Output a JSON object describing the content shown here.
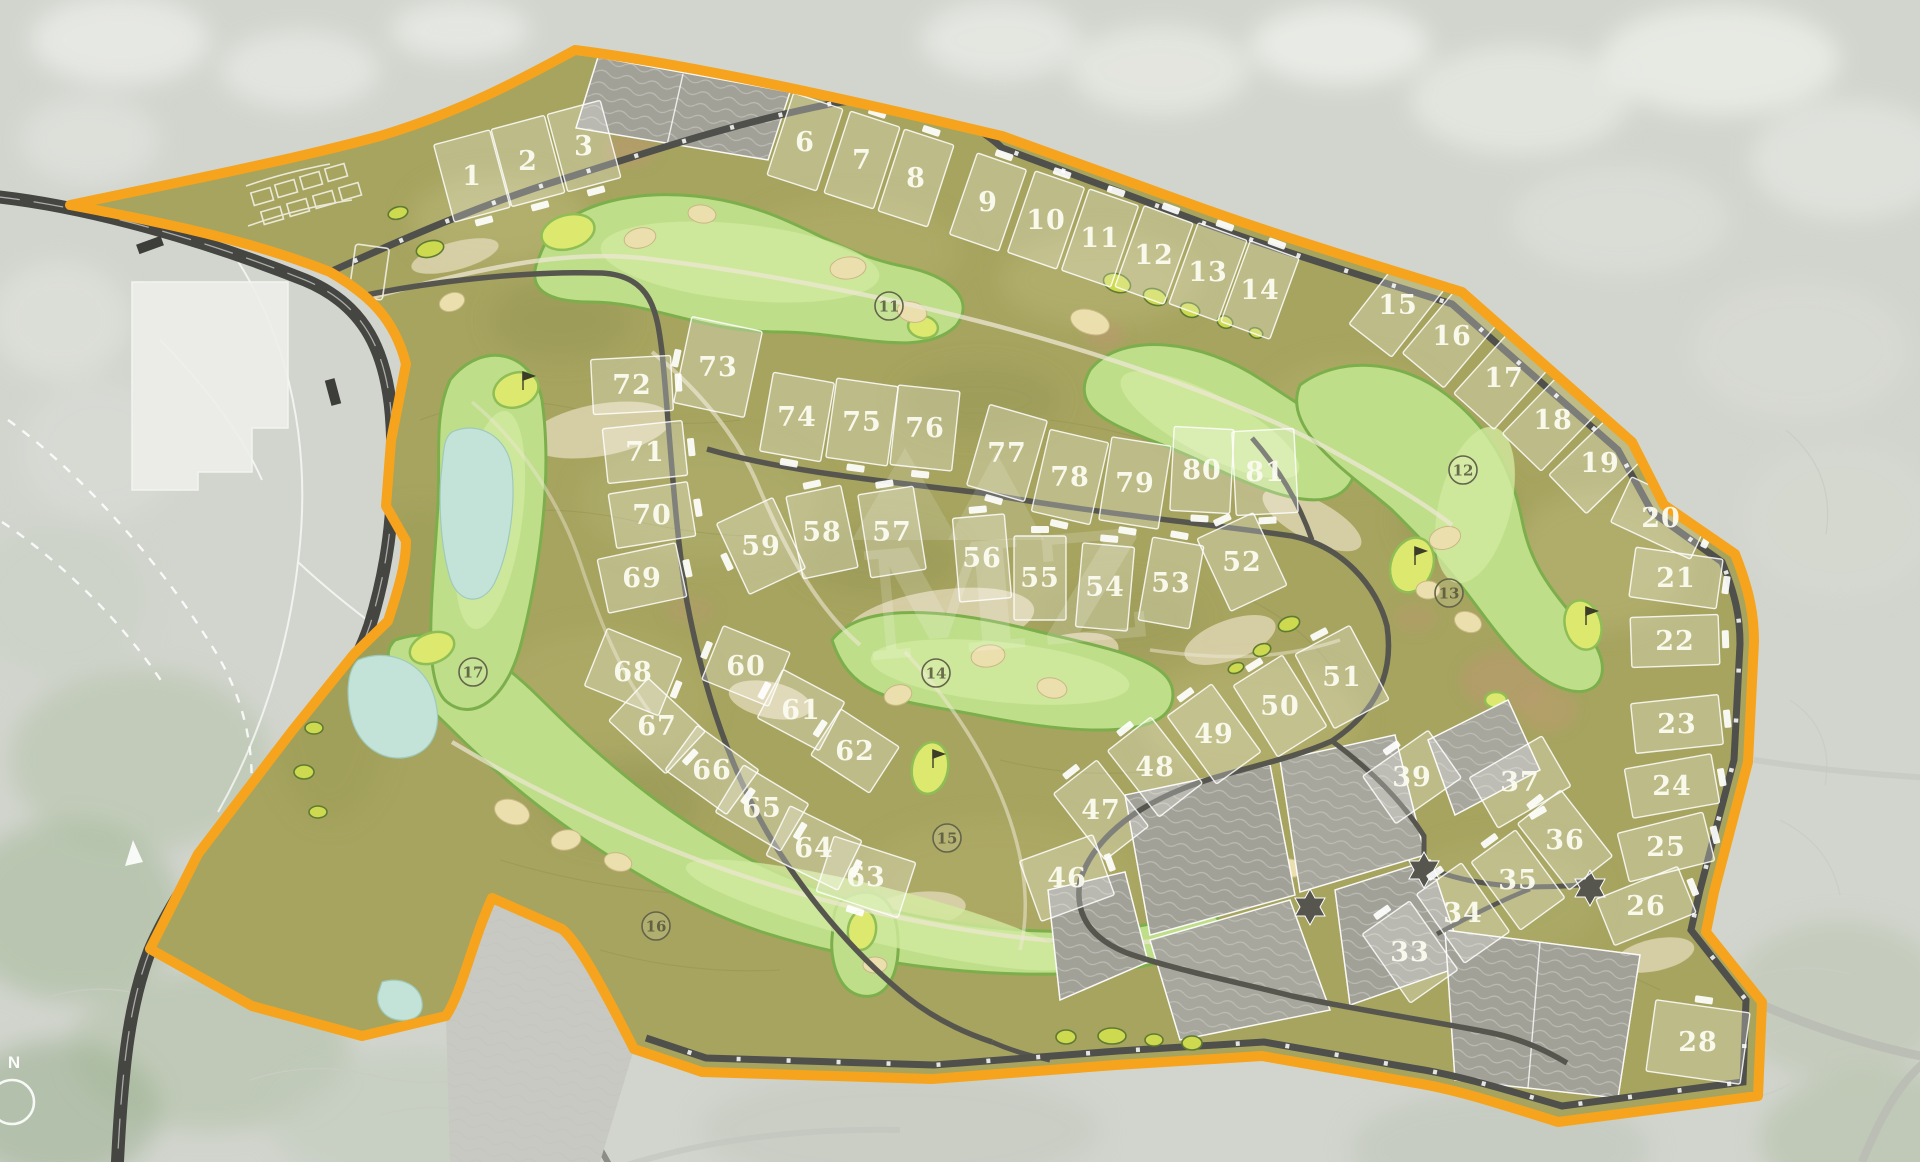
{
  "map": {
    "name": "golf-resort-master-plan",
    "watermark": {
      "text": "MZ"
    },
    "compass": {
      "label": "N"
    },
    "colors": {
      "boundary": "#F6A41D",
      "road": "#56564F",
      "loop_road": "#454542",
      "site_base": "#A6A45F",
      "fairway": "#BEDE8A",
      "fairway_edge": "#7DAE4C",
      "green": "#DCE96E",
      "bunker": "#ECDFAE",
      "water": "#C3E2D8",
      "sold_parcel": "#A2A198",
      "parcel_line": "#FFFFFF"
    },
    "plots": [
      {
        "n": "1",
        "x": 472,
        "y": 176,
        "a": -15,
        "w": 58,
        "h": 80,
        "g": "b"
      },
      {
        "n": "2",
        "x": 528,
        "y": 161,
        "a": -15,
        "w": 55,
        "h": 80,
        "g": "b"
      },
      {
        "n": "3",
        "x": 584,
        "y": 146,
        "a": -15,
        "w": 55,
        "h": 80,
        "g": "b"
      },
      {
        "n": "6",
        "x": 805,
        "y": 142,
        "a": 18,
        "w": 52,
        "h": 86,
        "g": "t"
      },
      {
        "n": "7",
        "x": 862,
        "y": 160,
        "a": 18,
        "w": 52,
        "h": 86,
        "g": "t"
      },
      {
        "n": "8",
        "x": 916,
        "y": 178,
        "a": 18,
        "w": 52,
        "h": 86,
        "g": "t"
      },
      {
        "n": "9",
        "x": 988,
        "y": 202,
        "a": 19,
        "w": 52,
        "h": 86,
        "g": "t"
      },
      {
        "n": "10",
        "x": 1046,
        "y": 220,
        "a": 19,
        "w": 52,
        "h": 86,
        "g": "t"
      },
      {
        "n": "11",
        "x": 1100,
        "y": 238,
        "a": 19,
        "w": 52,
        "h": 86,
        "g": "t"
      },
      {
        "n": "12",
        "x": 1154,
        "y": 255,
        "a": 20,
        "w": 52,
        "h": 86,
        "g": "t"
      },
      {
        "n": "13",
        "x": 1208,
        "y": 272,
        "a": 20,
        "w": 52,
        "h": 86,
        "g": "t"
      },
      {
        "n": "14",
        "x": 1260,
        "y": 290,
        "a": 20,
        "w": 52,
        "h": 86,
        "g": "t"
      },
      {
        "n": "15",
        "x": 1398,
        "y": 305,
        "a": 38,
        "w": 54,
        "h": 90,
        "g": "t"
      },
      {
        "n": "16",
        "x": 1452,
        "y": 336,
        "a": 40,
        "w": 54,
        "h": 90,
        "g": "t"
      },
      {
        "n": "17",
        "x": 1504,
        "y": 378,
        "a": 42,
        "w": 54,
        "h": 90,
        "g": "t"
      },
      {
        "n": "18",
        "x": 1553,
        "y": 420,
        "a": 44,
        "w": 54,
        "h": 90,
        "g": "t"
      },
      {
        "n": "19",
        "x": 1600,
        "y": 463,
        "a": 46,
        "w": 54,
        "h": 90,
        "g": "t"
      },
      {
        "n": "20",
        "x": 1661,
        "y": 518,
        "a": 25,
        "w": 88,
        "h": 50,
        "g": "r"
      },
      {
        "n": "21",
        "x": 1676,
        "y": 578,
        "a": 8,
        "w": 88,
        "h": 50,
        "g": "r"
      },
      {
        "n": "22",
        "x": 1675,
        "y": 641,
        "a": -2,
        "w": 88,
        "h": 50,
        "g": "r"
      },
      {
        "n": "23",
        "x": 1677,
        "y": 724,
        "a": -6,
        "w": 88,
        "h": 50,
        "g": "r"
      },
      {
        "n": "24",
        "x": 1672,
        "y": 786,
        "a": -10,
        "w": 88,
        "h": 50,
        "g": "r"
      },
      {
        "n": "25",
        "x": 1666,
        "y": 847,
        "a": -14,
        "w": 88,
        "h": 50,
        "g": "r"
      },
      {
        "n": "26",
        "x": 1646,
        "y": 906,
        "a": -22,
        "w": 88,
        "h": 50,
        "g": "r"
      },
      {
        "n": "28",
        "x": 1698,
        "y": 1042,
        "a": 8,
        "w": 95,
        "h": 72,
        "g": "t"
      },
      {
        "n": "33",
        "x": 1410,
        "y": 952,
        "a": -35,
        "w": 58,
        "h": 84,
        "g": "t"
      },
      {
        "n": "34",
        "x": 1463,
        "y": 913,
        "a": -35,
        "w": 55,
        "h": 84,
        "g": "t"
      },
      {
        "n": "35",
        "x": 1518,
        "y": 880,
        "a": -36,
        "w": 55,
        "h": 84,
        "g": "t"
      },
      {
        "n": "36",
        "x": 1565,
        "y": 840,
        "a": -38,
        "w": 55,
        "h": 84,
        "g": "t"
      },
      {
        "n": "37",
        "x": 1520,
        "y": 782,
        "a": -30,
        "w": 84,
        "h": 58,
        "g": "b"
      },
      {
        "n": "39",
        "x": 1412,
        "y": 777,
        "a": -35,
        "w": 80,
        "h": 58,
        "g": "t"
      },
      {
        "n": "46",
        "x": 1067,
        "y": 878,
        "a": -20,
        "w": 78,
        "h": 64,
        "g": "r"
      },
      {
        "n": "47",
        "x": 1101,
        "y": 810,
        "a": -38,
        "w": 55,
        "h": 84,
        "g": "t"
      },
      {
        "n": "48",
        "x": 1155,
        "y": 767,
        "a": -38,
        "w": 55,
        "h": 84,
        "g": "t"
      },
      {
        "n": "49",
        "x": 1214,
        "y": 734,
        "a": -36,
        "w": 55,
        "h": 84,
        "g": "t"
      },
      {
        "n": "50",
        "x": 1280,
        "y": 706,
        "a": -32,
        "w": 58,
        "h": 84,
        "g": "t"
      },
      {
        "n": "51",
        "x": 1342,
        "y": 677,
        "a": -28,
        "w": 62,
        "h": 84,
        "g": "t"
      },
      {
        "n": "52",
        "x": 1242,
        "y": 562,
        "a": -25,
        "w": 62,
        "h": 80,
        "g": "t"
      },
      {
        "n": "53",
        "x": 1171,
        "y": 583,
        "a": 10,
        "w": 52,
        "h": 84,
        "g": "t"
      },
      {
        "n": "54",
        "x": 1105,
        "y": 587,
        "a": 5,
        "w": 52,
        "h": 84,
        "g": "t"
      },
      {
        "n": "55",
        "x": 1040,
        "y": 578,
        "a": 0,
        "w": 52,
        "h": 84,
        "g": "t"
      },
      {
        "n": "56",
        "x": 982,
        "y": 558,
        "a": -5,
        "w": 52,
        "h": 84,
        "g": "t"
      },
      {
        "n": "57",
        "x": 892,
        "y": 532,
        "a": -9,
        "w": 56,
        "h": 84,
        "g": "t"
      },
      {
        "n": "58",
        "x": 822,
        "y": 532,
        "a": -12,
        "w": 56,
        "h": 84,
        "g": "t"
      },
      {
        "n": "59",
        "x": 761,
        "y": 546,
        "a": -25,
        "w": 62,
        "h": 78,
        "g": "l"
      },
      {
        "n": "60",
        "x": 746,
        "y": 666,
        "a": 22,
        "w": 72,
        "h": 58,
        "g": "l"
      },
      {
        "n": "61",
        "x": 801,
        "y": 710,
        "a": 28,
        "w": 70,
        "h": 55,
        "g": "l"
      },
      {
        "n": "62",
        "x": 855,
        "y": 751,
        "a": 33,
        "w": 70,
        "h": 55,
        "g": "l"
      },
      {
        "n": "63",
        "x": 866,
        "y": 877,
        "a": 18,
        "w": 86,
        "h": 58,
        "g": "b"
      },
      {
        "n": "64",
        "x": 814,
        "y": 848,
        "a": 26,
        "w": 80,
        "h": 55,
        "g": "r"
      },
      {
        "n": "65",
        "x": 762,
        "y": 808,
        "a": 31,
        "w": 76,
        "h": 55,
        "g": "r"
      },
      {
        "n": "66",
        "x": 712,
        "y": 770,
        "a": 36,
        "w": 76,
        "h": 55,
        "g": "r"
      },
      {
        "n": "67",
        "x": 657,
        "y": 726,
        "a": 43,
        "w": 78,
        "h": 58,
        "g": "r"
      },
      {
        "n": "68",
        "x": 633,
        "y": 672,
        "a": 22,
        "w": 80,
        "h": 62,
        "g": "r"
      },
      {
        "n": "69",
        "x": 642,
        "y": 578,
        "a": -12,
        "w": 80,
        "h": 55,
        "g": "r"
      },
      {
        "n": "70",
        "x": 652,
        "y": 515,
        "a": -9,
        "w": 80,
        "h": 55,
        "g": "r"
      },
      {
        "n": "71",
        "x": 645,
        "y": 452,
        "a": -6,
        "w": 80,
        "h": 55,
        "g": "r"
      },
      {
        "n": "72",
        "x": 632,
        "y": 385,
        "a": -3,
        "w": 80,
        "h": 55,
        "g": "r"
      },
      {
        "n": "73",
        "x": 718,
        "y": 367,
        "a": 12,
        "w": 72,
        "h": 88,
        "g": "l"
      },
      {
        "n": "74",
        "x": 797,
        "y": 417,
        "a": 10,
        "w": 62,
        "h": 80,
        "g": "b"
      },
      {
        "n": "75",
        "x": 862,
        "y": 422,
        "a": 8,
        "w": 62,
        "h": 80,
        "g": "b"
      },
      {
        "n": "76",
        "x": 925,
        "y": 428,
        "a": 6,
        "w": 62,
        "h": 80,
        "g": "b"
      },
      {
        "n": "77",
        "x": 1007,
        "y": 453,
        "a": 16,
        "w": 60,
        "h": 84,
        "g": "b"
      },
      {
        "n": "78",
        "x": 1070,
        "y": 477,
        "a": 13,
        "w": 60,
        "h": 84,
        "g": "b"
      },
      {
        "n": "79",
        "x": 1135,
        "y": 483,
        "a": 9,
        "w": 60,
        "h": 84,
        "g": "b"
      },
      {
        "n": "80",
        "x": 1202,
        "y": 470,
        "a": 3,
        "w": 60,
        "h": 84,
        "g": "b"
      },
      {
        "n": "81",
        "x": 1265,
        "y": 472,
        "a": -3,
        "w": 62,
        "h": 84,
        "g": "b"
      }
    ],
    "holes": [
      {
        "n": "11",
        "x": 889,
        "y": 306
      },
      {
        "n": "12",
        "x": 1463,
        "y": 470
      },
      {
        "n": "13",
        "x": 1449,
        "y": 593
      },
      {
        "n": "14",
        "x": 936,
        "y": 673
      },
      {
        "n": "15",
        "x": 947,
        "y": 838
      },
      {
        "n": "16",
        "x": 656,
        "y": 926
      },
      {
        "n": "17",
        "x": 473,
        "y": 672
      }
    ]
  }
}
